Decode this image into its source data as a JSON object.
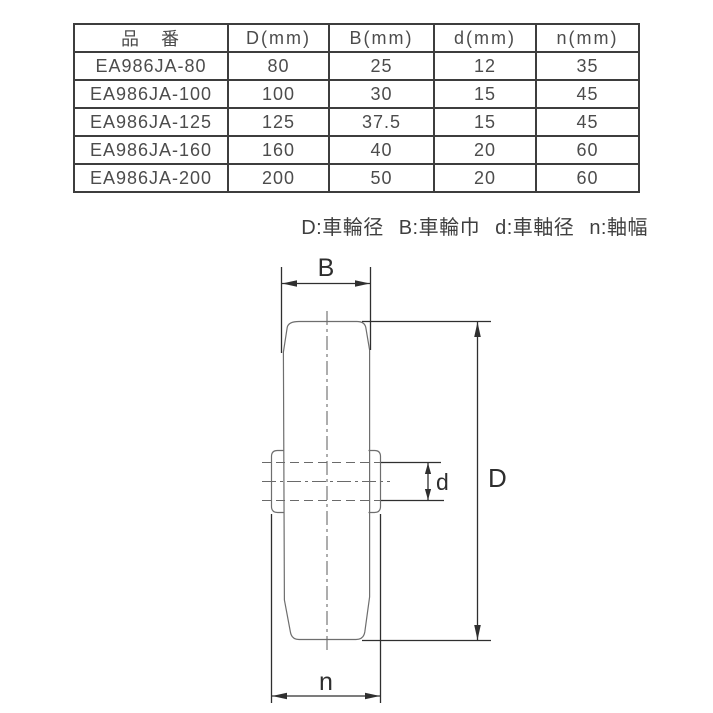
{
  "table": {
    "headers": [
      "品　番",
      "D(mm)",
      "B(mm)",
      "d(mm)",
      "n(mm)"
    ],
    "rows": [
      [
        "EA986JA-80",
        "80",
        "25",
        "12",
        "35"
      ],
      [
        "EA986JA-100",
        "100",
        "30",
        "15",
        "45"
      ],
      [
        "EA986JA-125",
        "125",
        "37.5",
        "15",
        "45"
      ],
      [
        "EA986JA-160",
        "160",
        "40",
        "20",
        "60"
      ],
      [
        "EA986JA-200",
        "200",
        "50",
        "20",
        "60"
      ]
    ]
  },
  "legend": {
    "items": [
      "D:車輪径",
      "B:車輪巾",
      "d:車軸径",
      "n:軸幅"
    ]
  },
  "diagram": {
    "labels": {
      "B": "B",
      "D": "D",
      "d": "d",
      "n": "n"
    }
  },
  "colors": {
    "background": "#ffffff",
    "table_border": "#3d3d3d",
    "text": "#4c4c4c",
    "drawing_line": "#6e6e6e",
    "dimension_line": "#2f2f2f"
  }
}
